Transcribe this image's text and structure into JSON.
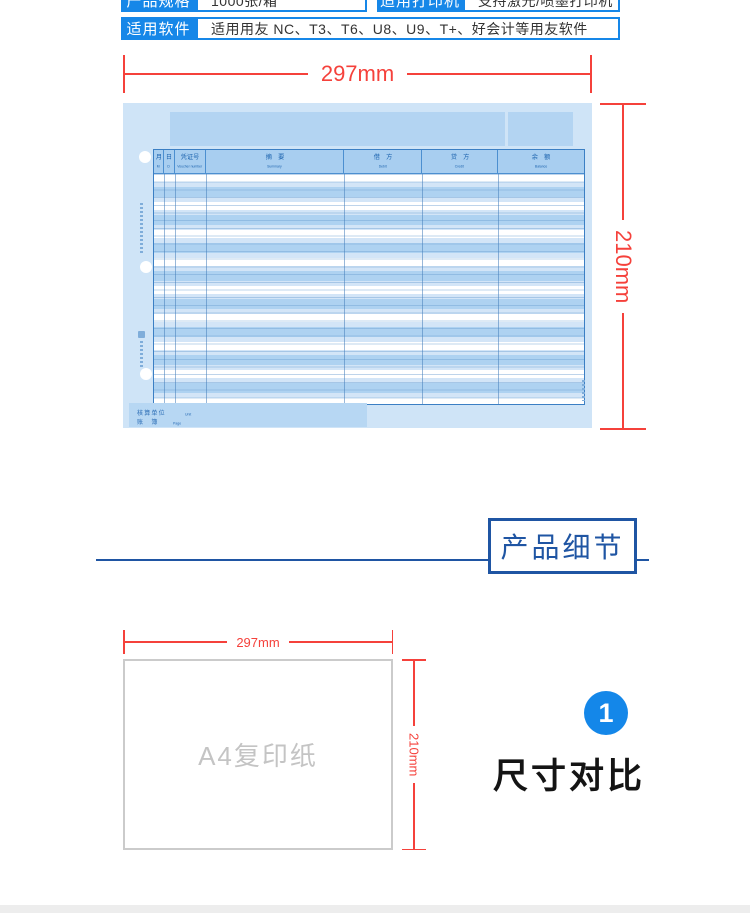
{
  "colors": {
    "accent_blue": "#1687e8",
    "dark_blue": "#1f55a3",
    "dim_red": "#f5413b",
    "paper_blue": "#cfe4f7",
    "badge_blue": "#1487e9"
  },
  "spec_table": {
    "rows": [
      {
        "label": "产品规格",
        "value": "1000张/箱"
      },
      {
        "label": "适用打印机",
        "value": "支持激光/喷墨打印机"
      },
      {
        "label": "适用软件",
        "value": "适用用友 NC、T3、T6、U8、U9、T+、好会计等用友软件"
      }
    ]
  },
  "ledger_figure": {
    "width_label": "297mm",
    "height_label": "210mm",
    "table": {
      "columns": [
        {
          "cn": "月",
          "en": "M"
        },
        {
          "cn": "日",
          "en": "D"
        },
        {
          "cn": "凭证号",
          "en": "Voucher number"
        },
        {
          "cn": "摘　要",
          "en": "Summary"
        },
        {
          "cn": "借　方",
          "en": "Debit"
        },
        {
          "cn": "贷　方",
          "en": "Credit"
        },
        {
          "cn": "余　额",
          "en": "Balance"
        }
      ]
    },
    "footer": {
      "line1_cn": "核算单位",
      "line1_en": "Unit",
      "line2_cn": "账　簿",
      "line2_en": "Page"
    }
  },
  "details_section": {
    "title": "产品细节"
  },
  "comparison_figure": {
    "width_label": "297mm",
    "height_label": "210mm",
    "paper_label": "A4复印纸"
  },
  "size_section": {
    "badge_number": "1",
    "title": "尺寸对比"
  }
}
